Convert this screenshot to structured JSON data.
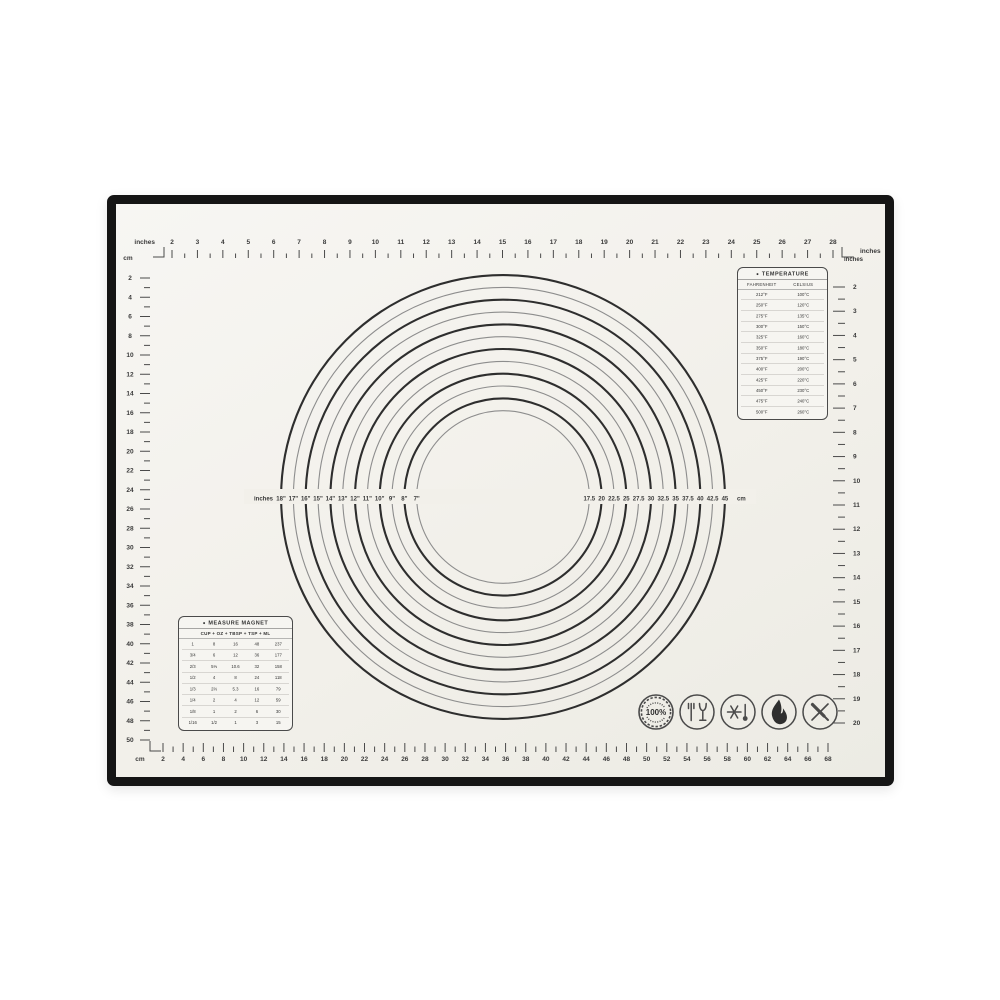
{
  "colors": {
    "background": "#ffffff",
    "mat_surface": "#f2f0ea",
    "mat_border": "#151515",
    "print_dark": "#2e2e2e",
    "print_gray": "#8d8d8d",
    "ink": "#3a3a3a"
  },
  "mat": {
    "rulers": {
      "top": {
        "unit": "inches",
        "values": [
          2,
          3,
          4,
          5,
          6,
          7,
          8,
          9,
          10,
          11,
          12,
          13,
          14,
          15,
          16,
          17,
          18,
          19,
          20,
          21,
          22,
          23,
          24,
          25,
          26,
          27,
          28
        ]
      },
      "left": {
        "unit": "cm",
        "values": [
          2,
          4,
          6,
          8,
          10,
          12,
          14,
          16,
          18,
          20,
          22,
          24,
          26,
          28,
          30,
          32,
          34,
          36,
          38,
          40,
          42,
          44,
          46,
          48,
          50
        ]
      },
      "right": {
        "unit": "inches",
        "values": [
          2,
          3,
          4,
          5,
          6,
          7,
          8,
          9,
          10,
          11,
          12,
          13,
          14,
          15,
          16,
          17,
          18,
          19,
          20
        ]
      },
      "bottom": {
        "unit": "cm",
        "values": [
          2,
          4,
          6,
          8,
          10,
          12,
          14,
          16,
          18,
          20,
          22,
          24,
          26,
          28,
          30,
          32,
          34,
          36,
          38,
          40,
          42,
          44,
          46,
          48,
          50,
          52,
          54,
          56,
          58,
          60,
          62,
          64,
          66,
          68
        ]
      }
    },
    "circle_guide": {
      "left_unit": "inches",
      "diameter_labels": [
        "18\"",
        "17\"",
        "16\"",
        "15\"",
        "14\"",
        "13\"",
        "12\"",
        "11\"",
        "10\"",
        "9\"",
        "8\"",
        "7\""
      ],
      "cm_labels": [
        "17.5",
        "20",
        "22.5",
        "25",
        "27.5",
        "30",
        "32.5",
        "35",
        "37.5",
        "40",
        "42.5",
        "45"
      ],
      "right_unit": "cm"
    },
    "temperature_table": {
      "bullet": "●",
      "title": "TEMPERATURE",
      "col1": "FAHRENHEIT",
      "col2": "CELSIUS",
      "rows": [
        [
          "212°F",
          "100°C"
        ],
        [
          "250°F",
          "120°C"
        ],
        [
          "275°F",
          "135°C"
        ],
        [
          "300°F",
          "150°C"
        ],
        [
          "325°F",
          "160°C"
        ],
        [
          "350°F",
          "180°C"
        ],
        [
          "375°F",
          "190°C"
        ],
        [
          "400°F",
          "200°C"
        ],
        [
          "425°F",
          "220°C"
        ],
        [
          "450°F",
          "230°C"
        ],
        [
          "475°F",
          "240°C"
        ],
        [
          "500°F",
          "260°C"
        ]
      ]
    },
    "measure_table": {
      "bullet": "●",
      "title": "MEASURE MAGNET",
      "header": "CUP + OZ + TBSP + TSP + ML",
      "rows": [
        [
          "1",
          "8",
          "16",
          "48",
          "237"
        ],
        [
          "3/4",
          "6",
          "12",
          "36",
          "177"
        ],
        [
          "2/3",
          "5⅓",
          "10.6",
          "32",
          "158"
        ],
        [
          "1/2",
          "4",
          "8",
          "24",
          "118"
        ],
        [
          "1/3",
          "2⅔",
          "5.3",
          "16",
          "79"
        ],
        [
          "1/4",
          "2",
          "4",
          "12",
          "59"
        ],
        [
          "1/8",
          "1",
          "2",
          "6",
          "30"
        ],
        [
          "1/16",
          "1/2",
          "1",
          "3",
          "15"
        ]
      ]
    },
    "badges": {
      "guarantee_label": "100%"
    }
  }
}
